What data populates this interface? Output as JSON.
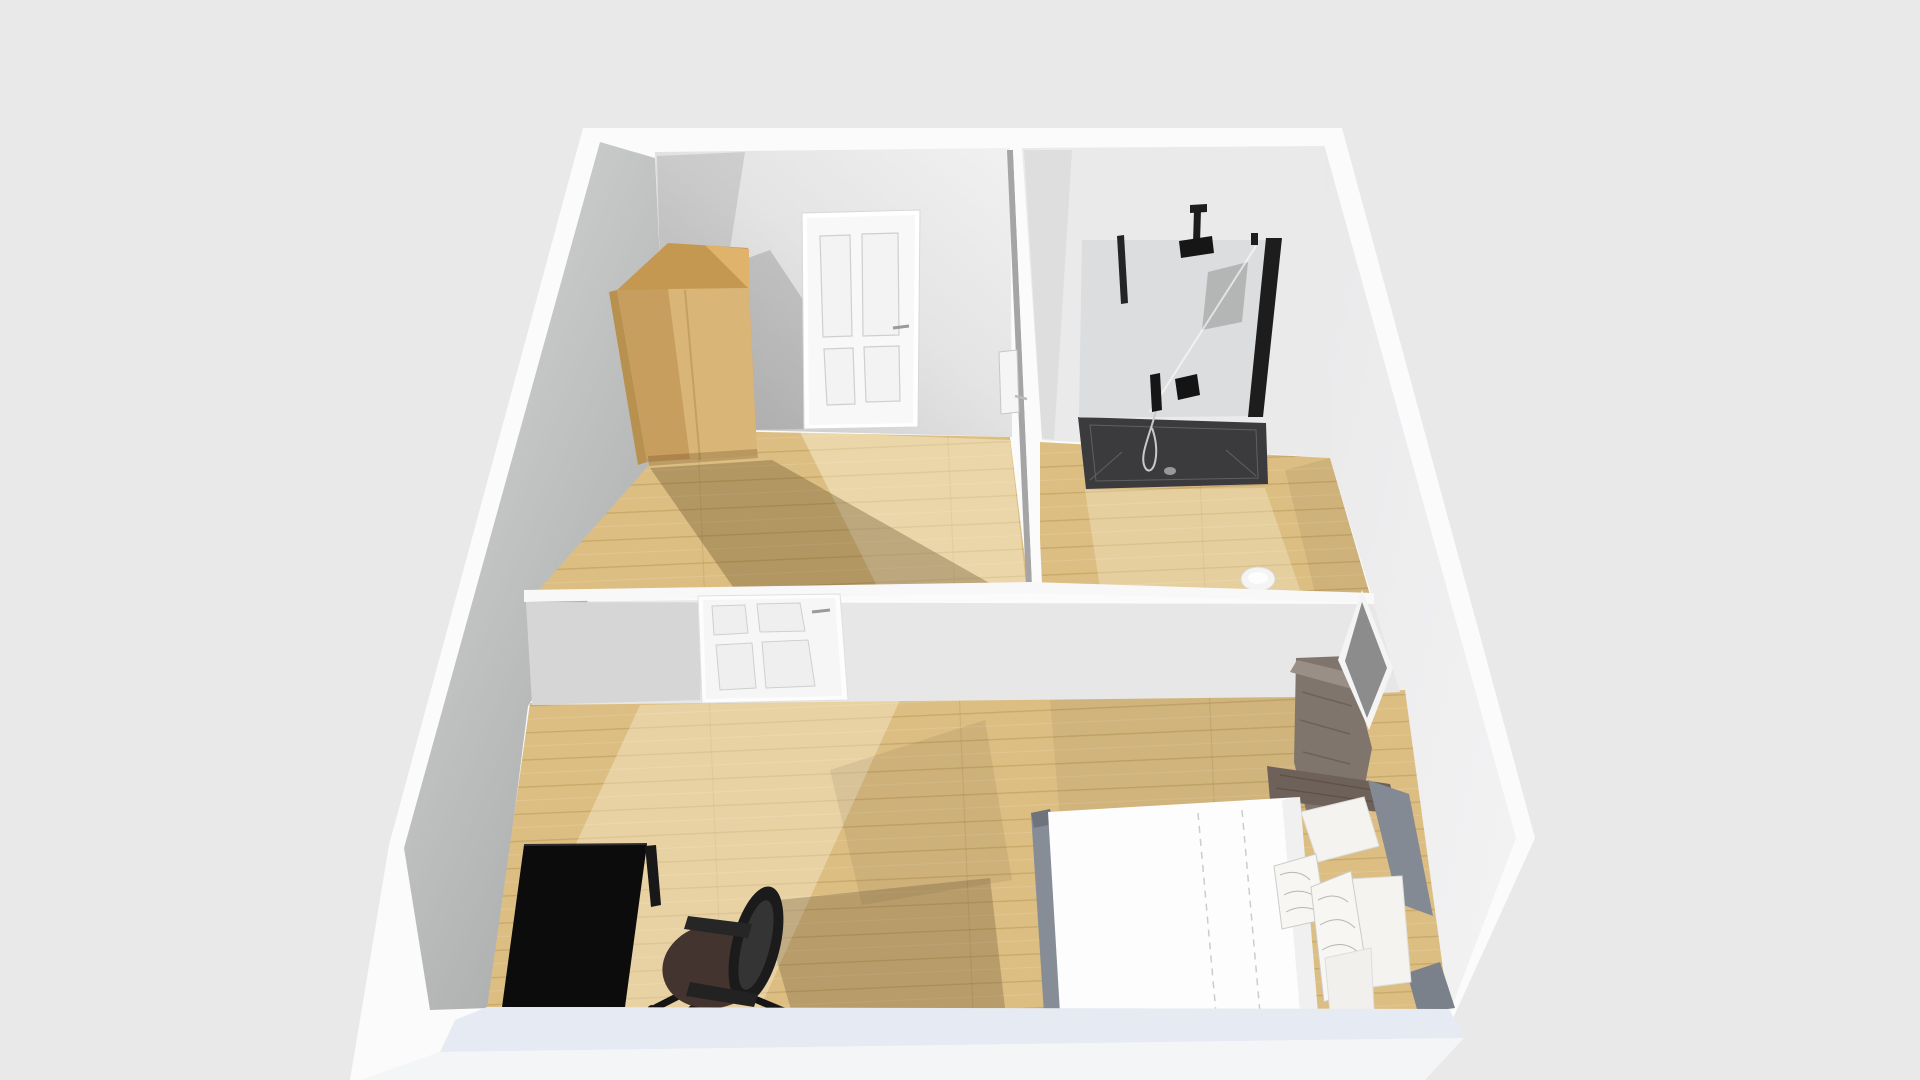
{
  "scene": {
    "view_label": "3D floor plan perspective view",
    "rooms": [
      {
        "name": "closet-room",
        "objects": [
          "wardrobe",
          "interior-door-back"
        ]
      },
      {
        "name": "bathroom",
        "objects": [
          "walk-in-shower",
          "shower-glass-panel",
          "rain-shower-head",
          "handheld-shower",
          "shower-tray",
          "floor-drain",
          "toilet"
        ]
      },
      {
        "name": "bedroom",
        "objects": [
          "double-bed",
          "duvet",
          "pillows",
          "headboard",
          "dresser",
          "mirror-panel",
          "interior-door-divider",
          "desk",
          "office-chair"
        ]
      }
    ]
  },
  "colors": {
    "background": "#e9e9e9",
    "wall_outer": "#fbfbfb",
    "wall_top_band": "#fdfdfd",
    "wall_inner_light": "#ededee",
    "wall_inner_mid": "#e7e7e7",
    "divider_face": "#e7e7e7",
    "divider_strip": "#f8f8f8",
    "front_wall_top": "#e6eaf2",
    "front_wall_face": "#f4f5f7",
    "floor_base": "#dcbe82",
    "floor_line": "#b49455",
    "door_white": "#f8f8f8",
    "door_panel_line": "#cfcfcf",
    "door_handle": "#9a9a9a",
    "wardrobe_front": "#c89e5f",
    "wardrobe_front_light": "#dcba7c",
    "wardrobe_top": "#c59851",
    "wardrobe_top_light": "#e0b36d",
    "wardrobe_side": "#b8914f",
    "glass": "rgba(203,207,210,0.5)",
    "fixture_black": "#1d1d1d",
    "tray": "#3b3b3d",
    "tray_line": "#606060",
    "drain": "#989898",
    "toilet": "#f4f4f2",
    "dresser": "#7f756c",
    "dresser_top": "#998f86",
    "mirror_glass": "#8c8c8c",
    "mirror_frame": "#f4f4f4",
    "headboard": "#6e6159",
    "bed_rail": "#848a94",
    "duvet": "#fdfdfd",
    "duvet_stitch": "#c8ccd5",
    "pillow": "#f4f3ef",
    "pillow_pattern": "#b4b7b1",
    "desk": "#0c0c0c",
    "desk_leg": "#181818",
    "chair_seat": "#443430",
    "chair_black": "#1b1b1b",
    "chair_mesh": "#343434"
  }
}
